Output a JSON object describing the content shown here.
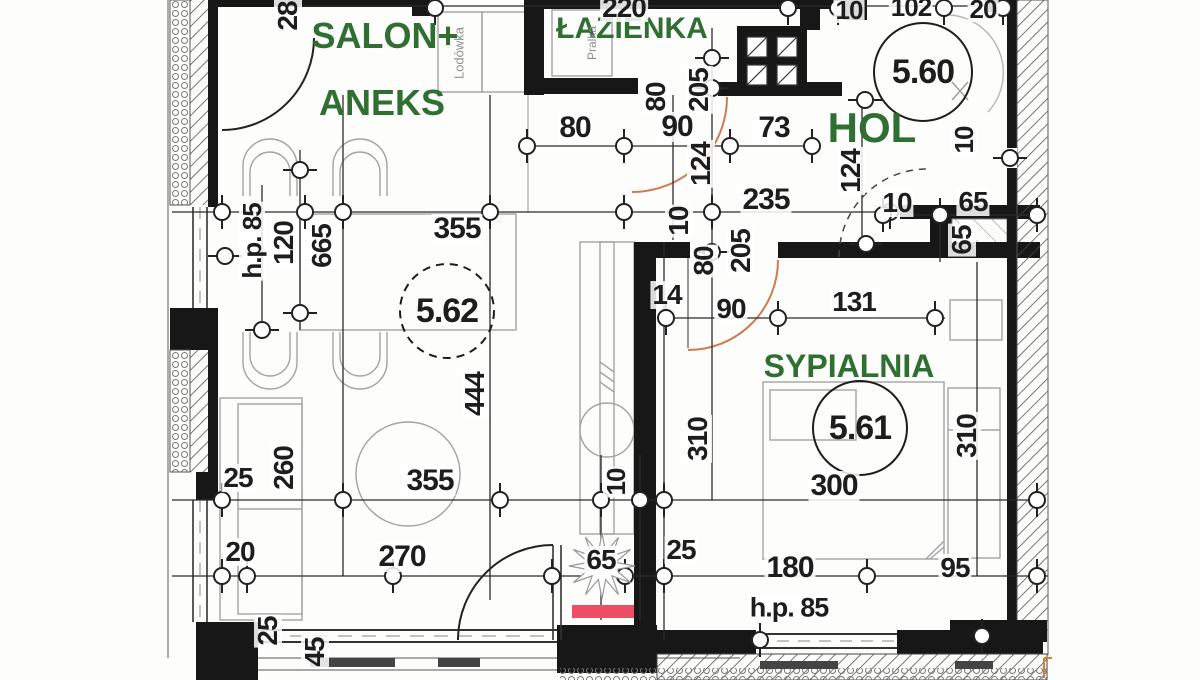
{
  "drawing": {
    "kind": "apartment floor plan (scanned)",
    "language": "pl",
    "rooms": [
      {
        "label": "SALON+ ANEKS",
        "number": "5.62"
      },
      {
        "label": "ŁAZIENKA",
        "number": ""
      },
      {
        "label": "HOL",
        "number": "5.60"
      },
      {
        "label": "SYPIALNIA",
        "number": "5.61"
      }
    ]
  },
  "colors": {
    "room_label_green": "#2f7032",
    "dimension_text": "#1d1d1d",
    "wall_black": "#171717",
    "door_arc_orange": "#cf7a50",
    "highlight_red": "#ee4d66",
    "furniture_gray": "#a3a3a3",
    "paper": "#fdfdfc"
  },
  "labels": [
    {
      "text": "SALON+",
      "x": 385,
      "y": 36,
      "rot": 0,
      "size": 36,
      "kind": "room"
    },
    {
      "text": "ANEKS",
      "x": 382,
      "y": 103,
      "rot": 0,
      "size": 36,
      "kind": "room"
    },
    {
      "text": "ŁAZIENKA",
      "x": 632,
      "y": 29,
      "rot": 0,
      "size": 30,
      "kind": "room"
    },
    {
      "text": "HOL",
      "x": 872,
      "y": 128,
      "rot": 0,
      "size": 42,
      "kind": "room"
    },
    {
      "text": "SYPIALNIA",
      "x": 849,
      "y": 366,
      "rot": 0,
      "size": 32,
      "kind": "room"
    },
    {
      "text": "5.60",
      "x": 923,
      "y": 72,
      "rot": 0,
      "size": 34,
      "kind": "num"
    },
    {
      "text": "5.62",
      "x": 447,
      "y": 311,
      "rot": 0,
      "size": 34,
      "kind": "num"
    },
    {
      "text": "5.61",
      "x": 860,
      "y": 428,
      "rot": 0,
      "size": 34,
      "kind": "num"
    },
    {
      "text": "Lodówka",
      "x": 459,
      "y": 53,
      "rot": -90,
      "size": 13,
      "kind": "gray"
    },
    {
      "text": "Pralka",
      "x": 592,
      "y": 43,
      "rot": -90,
      "size": 12,
      "kind": "gray"
    },
    {
      "text": "28",
      "x": 288,
      "y": 16,
      "rot": -90,
      "size": 28,
      "kind": "dim"
    },
    {
      "text": "220",
      "x": 624,
      "y": 8,
      "rot": 0,
      "size": 28,
      "kind": "dim"
    },
    {
      "text": "10",
      "x": 849,
      "y": 10,
      "rot": 0,
      "size": 26,
      "kind": "dim"
    },
    {
      "text": "102",
      "x": 911,
      "y": 7,
      "rot": 0,
      "size": 26,
      "kind": "dim"
    },
    {
      "text": "20",
      "x": 983,
      "y": 9,
      "rot": 0,
      "size": 26,
      "kind": "dim"
    },
    {
      "text": "80",
      "x": 575,
      "y": 128,
      "rot": 0,
      "size": 30,
      "kind": "dim"
    },
    {
      "text": "90",
      "x": 677,
      "y": 127,
      "rot": 0,
      "size": 30,
      "kind": "dim"
    },
    {
      "text": "73",
      "x": 774,
      "y": 128,
      "rot": 0,
      "size": 30,
      "kind": "dim"
    },
    {
      "text": "80",
      "x": 656,
      "y": 97,
      "rot": -90,
      "size": 28,
      "kind": "dim"
    },
    {
      "text": "205",
      "x": 699,
      "y": 90,
      "rot": -90,
      "size": 28,
      "kind": "dim"
    },
    {
      "text": "124",
      "x": 701,
      "y": 164,
      "rot": -90,
      "size": 28,
      "kind": "dim"
    },
    {
      "text": "10",
      "x": 679,
      "y": 221,
      "rot": -90,
      "size": 28,
      "kind": "dim"
    },
    {
      "text": "80",
      "x": 704,
      "y": 261,
      "rot": -90,
      "size": 28,
      "kind": "dim"
    },
    {
      "text": "205",
      "x": 741,
      "y": 251,
      "rot": -90,
      "size": 28,
      "kind": "dim"
    },
    {
      "text": "355",
      "x": 457,
      "y": 229,
      "rot": 0,
      "size": 30,
      "kind": "dim"
    },
    {
      "text": "235",
      "x": 766,
      "y": 200,
      "rot": 0,
      "size": 30,
      "kind": "dim"
    },
    {
      "text": "h.p. 85",
      "x": 252,
      "y": 241,
      "rot": -90,
      "size": 26,
      "kind": "dim"
    },
    {
      "text": "120",
      "x": 284,
      "y": 243,
      "rot": -90,
      "size": 28,
      "kind": "dim"
    },
    {
      "text": "665",
      "x": 322,
      "y": 246,
      "rot": -90,
      "size": 28,
      "kind": "dim"
    },
    {
      "text": "444",
      "x": 475,
      "y": 394,
      "rot": -90,
      "size": 28,
      "kind": "dim"
    },
    {
      "text": "14",
      "x": 667,
      "y": 295,
      "rot": 0,
      "size": 28,
      "kind": "dim"
    },
    {
      "text": "90",
      "x": 731,
      "y": 309,
      "rot": 0,
      "size": 28,
      "kind": "dim"
    },
    {
      "text": "131",
      "x": 854,
      "y": 302,
      "rot": 0,
      "size": 28,
      "kind": "dim"
    },
    {
      "text": "310",
      "x": 698,
      "y": 439,
      "rot": -90,
      "size": 28,
      "kind": "dim"
    },
    {
      "text": "310",
      "x": 967,
      "y": 436,
      "rot": -90,
      "size": 28,
      "kind": "dim"
    },
    {
      "text": "25",
      "x": 238,
      "y": 478,
      "rot": 0,
      "size": 28,
      "kind": "dim"
    },
    {
      "text": "260",
      "x": 284,
      "y": 468,
      "rot": -90,
      "size": 28,
      "kind": "dim"
    },
    {
      "text": "355",
      "x": 430,
      "y": 481,
      "rot": 0,
      "size": 30,
      "kind": "dim"
    },
    {
      "text": "10",
      "x": 616,
      "y": 482,
      "rot": -90,
      "size": 26,
      "kind": "dim"
    },
    {
      "text": "300",
      "x": 834,
      "y": 486,
      "rot": 0,
      "size": 30,
      "kind": "dim"
    },
    {
      "text": "20",
      "x": 240,
      "y": 552,
      "rot": 0,
      "size": 28,
      "kind": "dim"
    },
    {
      "text": "270",
      "x": 402,
      "y": 557,
      "rot": 0,
      "size": 30,
      "kind": "dim"
    },
    {
      "text": "65",
      "x": 601,
      "y": 560,
      "rot": 0,
      "size": 28,
      "kind": "dim"
    },
    {
      "text": "25",
      "x": 681,
      "y": 550,
      "rot": 0,
      "size": 28,
      "kind": "dim"
    },
    {
      "text": "180",
      "x": 790,
      "y": 568,
      "rot": 0,
      "size": 30,
      "kind": "dim"
    },
    {
      "text": "95",
      "x": 955,
      "y": 568,
      "rot": 0,
      "size": 28,
      "kind": "dim"
    },
    {
      "text": "h.p. 85",
      "x": 789,
      "y": 608,
      "rot": 0,
      "size": 27,
      "kind": "dim"
    },
    {
      "text": "25",
      "x": 268,
      "y": 631,
      "rot": -90,
      "size": 28,
      "kind": "dim"
    },
    {
      "text": "45",
      "x": 315,
      "y": 652,
      "rot": -90,
      "size": 28,
      "kind": "dim"
    },
    {
      "text": "124",
      "x": 851,
      "y": 171,
      "rot": -90,
      "size": 28,
      "kind": "dim"
    },
    {
      "text": "10",
      "x": 964,
      "y": 140,
      "rot": -90,
      "size": 26,
      "kind": "dim"
    },
    {
      "text": "10",
      "x": 897,
      "y": 203,
      "rot": 0,
      "size": 28,
      "kind": "dim"
    },
    {
      "text": "65",
      "x": 973,
      "y": 202,
      "rot": 0,
      "size": 28,
      "kind": "dim"
    },
    {
      "text": "65",
      "x": 962,
      "y": 240,
      "rot": -90,
      "size": 28,
      "kind": "dim"
    }
  ]
}
